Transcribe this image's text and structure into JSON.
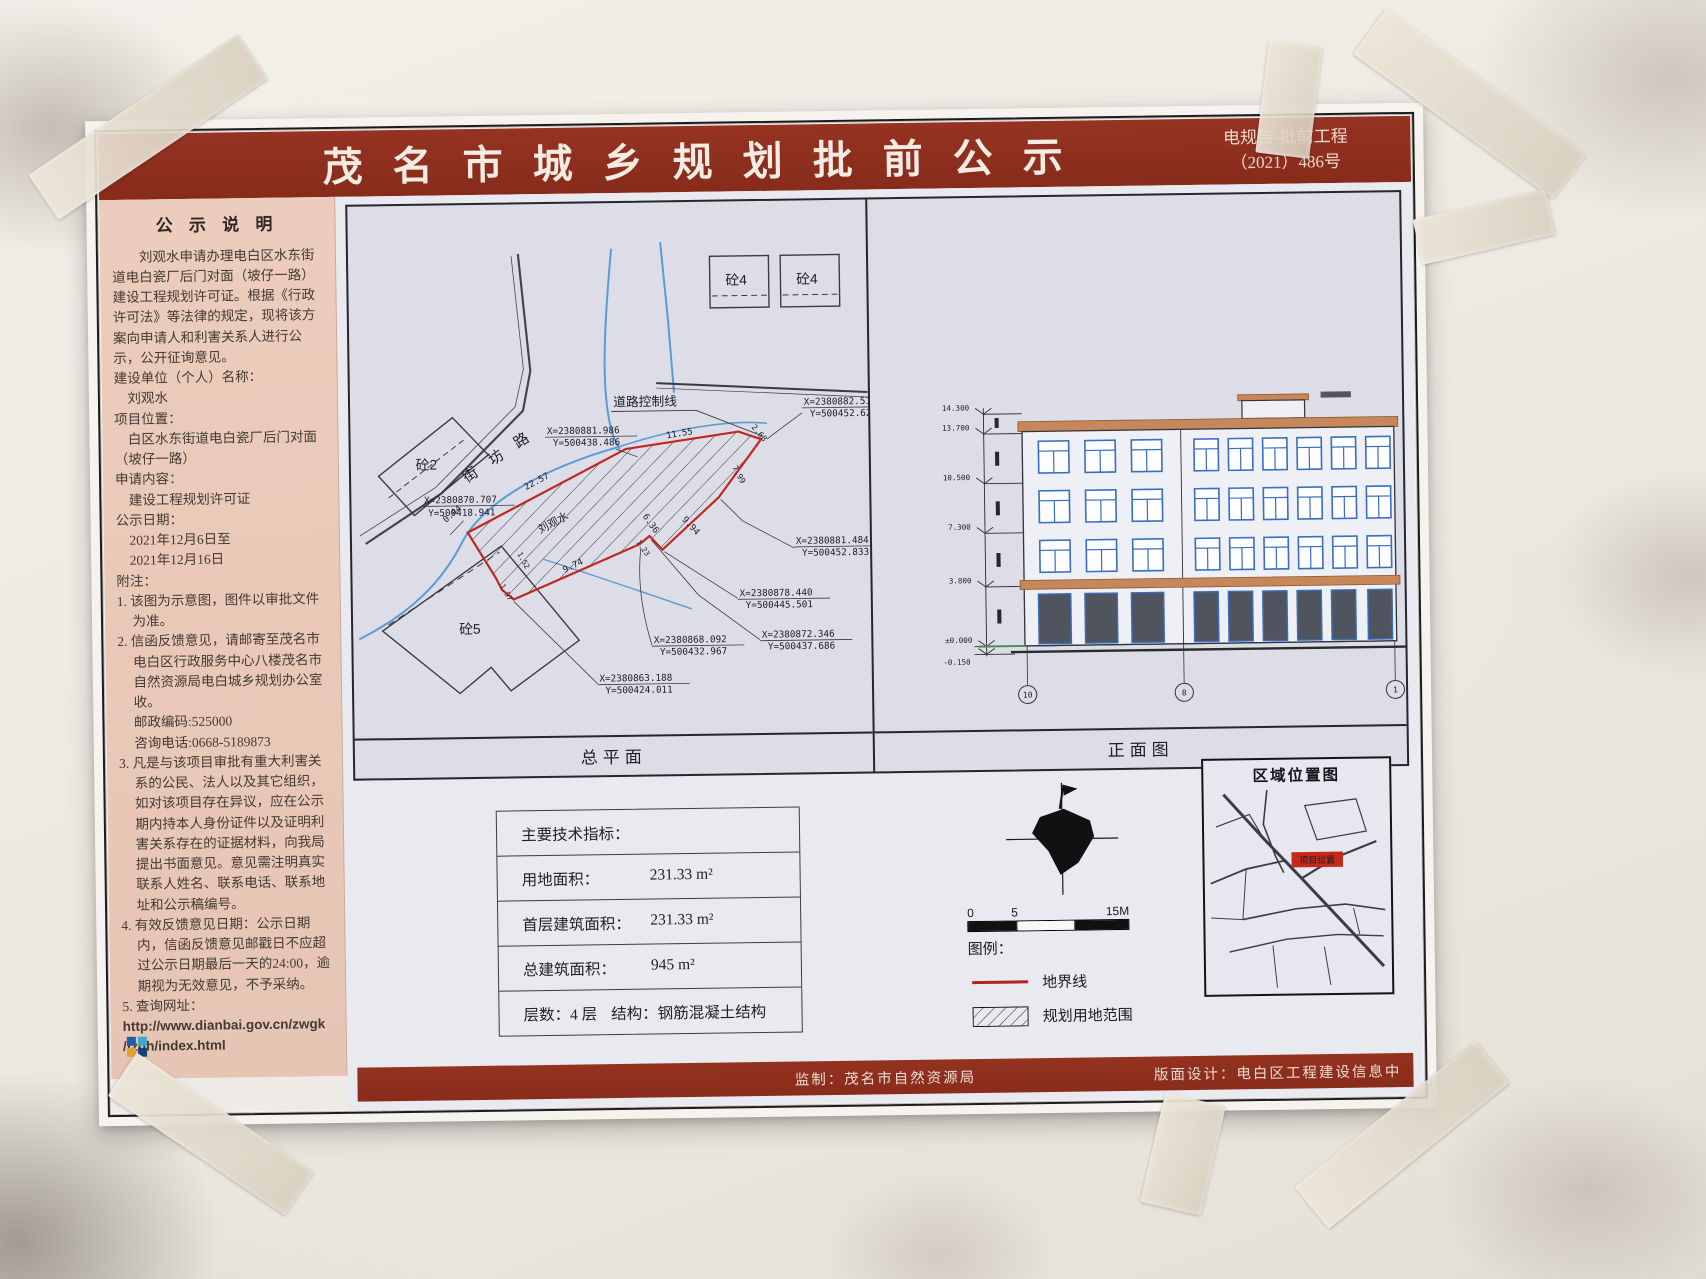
{
  "banner": {
    "title": "茂 名 市 城 乡 规 划 批 前 公 示",
    "doc_no_line1": "电规告-批前工程",
    "doc_no_line2": "（2021）486号"
  },
  "sidebar": {
    "heading": "公 示 说 明",
    "intro": "刘观水申请办理电白区水东街道电白瓷厂后门对面（坡仔一路）建设工程规划许可证。根据《行政许可法》等法律的规定，现将该方案向申请人和利害关系人进行公示，公开征询意见。",
    "fields": [
      {
        "label": "建设单位（个人）名称：",
        "value": "刘观水"
      },
      {
        "label": "项目位置：",
        "value": "白区水东街道电白瓷厂后门对面",
        "value2": "（坡仔一路）"
      },
      {
        "label": "申请内容：",
        "value": "建设工程规划许可证"
      },
      {
        "label": "公示日期：",
        "value": "2021年12月6日至",
        "value2": "2021年12月16日"
      }
    ],
    "notes_heading": "附注：",
    "notes": [
      "1. 该图为示意图，图件以审批文件为准。",
      "2. 信函反馈意见，请邮寄至茂名市电白区行政服务中心八楼茂名市自然资源局电白城乡规划办公室收。",
      "3. 凡是与该项目审批有重大利害关系的公民、法人以及其它组织，如对该项目存在异议，应在公示期内持本人身份证件以及证明利害关系存在的证据材料，向我局提出书面意见。意见需注明真实联系人姓名、联系电话、联系地址和公示稿编号。",
      "4. 有效反馈意见日期：公示日期内，信函反馈意见邮戳日不应超过公示日期最后一天的24:00，逾期视为无效意见，不予采纳。",
      "5. 查询网址："
    ],
    "postcode": "邮政编码:525000",
    "phone": "咨询电话:0668-5189873",
    "url_line1": "http://www.dianbai.gov.cn/zwgk",
    "url_line2": "/fzgh/index.html"
  },
  "site_plan": {
    "caption": "总平面",
    "road_name": "街 坊 路",
    "control_line_label": "道路控制线",
    "owner_label": "刘观水",
    "buildings": {
      "b2": "砼2",
      "b4a": "砼4",
      "b4b": "砼4",
      "b5": "砼5"
    },
    "coords": {
      "c1x": "X=2380882.512",
      "c1y": "Y=500452.625",
      "c2x": "X=2380881.986",
      "c2y": "Y=500438.486",
      "c3x": "X=2380870.707",
      "c3y": "Y=500418.941",
      "c4x": "X=2380881.484",
      "c4y": "Y=500452.833",
      "c5x": "X=2380878.440",
      "c5y": "Y=500445.501",
      "c6x": "X=2380872.346",
      "c6y": "Y=500437.686",
      "c7x": "X=2380868.092",
      "c7y": "Y=500432.967",
      "c8x": "X=2380863.188",
      "c8y": "Y=500424.011"
    },
    "dims": {
      "d1": "22.57",
      "d2": "11.55",
      "d3": "2.68",
      "d4": "7.99",
      "d5": "9.94",
      "d6": "6.36",
      "d7": "9.74",
      "d8": "1.52",
      "d9": "1.57",
      "d10": "0.44",
      "d11": "1.23"
    }
  },
  "elevation": {
    "caption": "正面图",
    "levels": {
      "l1": "14.300",
      "l2": "13.700",
      "l3": "10.500",
      "l4": "7.300",
      "l5": "3.800",
      "l6": "±0.000",
      "l7": "-0.150"
    },
    "axes": {
      "a1": "10",
      "a2": "8",
      "a3": "1"
    }
  },
  "indicators": {
    "title": "主要技术指标：",
    "rows": [
      {
        "label": "用地面积：",
        "value": "231.33 m²"
      },
      {
        "label": "首层建筑面积：",
        "value": "231.33 m²"
      },
      {
        "label": "总建筑面积：",
        "value": "945 m²"
      },
      {
        "label": "层数：4 层",
        "value": "结构：钢筋混凝土结构"
      }
    ]
  },
  "legend": {
    "scale0": "0",
    "scale5": "5",
    "scale15": "15M",
    "heading": "图例：",
    "boundary": "地界线",
    "planning_area": "规划用地范围"
  },
  "location_map": {
    "title": "区域位置图",
    "marker": "项目位置"
  },
  "footer": {
    "producer": "监制：茂名市自然资源局",
    "designer": "版面设计：电白区工程建设信息中"
  },
  "colors": {
    "banner_red": "#8e3021",
    "boundary_red": "#b3241e",
    "sidebar_pink": "#e9c9ba",
    "drawing_bg": "#dcdde7"
  }
}
